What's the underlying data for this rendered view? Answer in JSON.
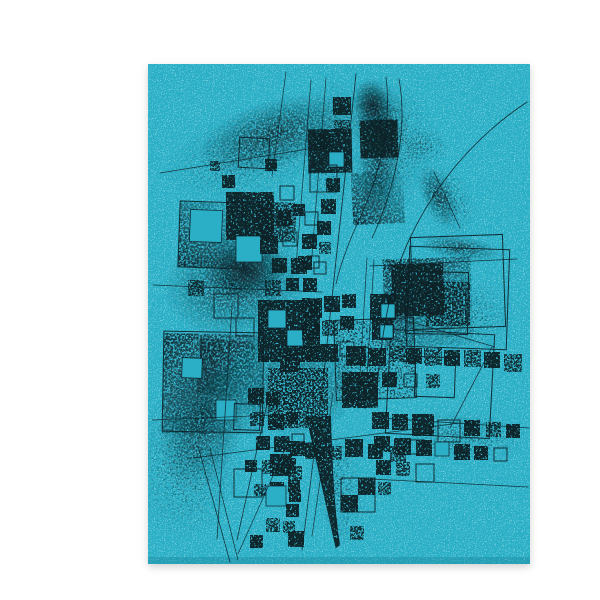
{
  "scene": {
    "description": "Abstract geometric ink print on bright teal paper: stippled squares, thin straight lines and sweeping arcs in black ink, photographed on a white background",
    "background_color": "#ffffff",
    "canvas": {
      "width": 600,
      "height": 600
    },
    "paper": {
      "x": 108,
      "y": 48,
      "width": 382,
      "height": 500,
      "color": "#2bafc7"
    }
  },
  "palette": {
    "ink": "#0c2027",
    "ink_soft": "#123039",
    "paper_teal": "#2bafc7",
    "paper_speckle": "#bdeef2",
    "edge_shade": "#147f96",
    "shadow": "#000000"
  },
  "artwork": {
    "squares": [
      [
        139,
        186,
        66,
        "gbl",
        2
      ],
      [
        123,
        318,
        100,
        "gtl",
        1
      ],
      [
        344,
        242,
        88,
        "gtl",
        -2
      ],
      [
        352,
        248,
        52,
        "d",
        -2
      ],
      [
        295,
        303,
        80,
        "l",
        -2
      ],
      [
        186,
        176,
        48,
        "d",
        0
      ],
      [
        216,
        186,
        40,
        "m",
        2
      ],
      [
        268,
        113,
        44,
        "d",
        -1
      ],
      [
        320,
        104,
        38,
        "d",
        -2
      ],
      [
        312,
        156,
        52,
        "gbl",
        -3
      ],
      [
        218,
        284,
        62,
        "d",
        0
      ],
      [
        158,
        324,
        56,
        "gtl",
        3
      ],
      [
        228,
        352,
        60,
        "m",
        0
      ],
      [
        386,
        266,
        44,
        "m",
        0
      ],
      [
        302,
        356,
        36,
        "d",
        0
      ],
      [
        139,
        186,
        66,
        "o",
        2
      ],
      [
        123,
        316,
        100,
        "o",
        1
      ],
      [
        368,
        232,
        100,
        "o",
        2
      ],
      [
        372,
        220,
        92,
        "o",
        -2
      ],
      [
        366,
        256,
        62,
        "o",
        1
      ],
      [
        348,
        316,
        104,
        "o",
        3
      ],
      [
        295,
        303,
        80,
        "o",
        -2
      ],
      [
        375,
        341,
        40,
        "o",
        2
      ],
      [
        199,
        122,
        30,
        "o",
        3
      ],
      [
        225,
        143,
        12,
        "d",
        0
      ],
      [
        182,
        159,
        13,
        "d",
        0
      ],
      [
        170,
        145,
        10,
        "m",
        0
      ],
      [
        293,
        81,
        18,
        "d",
        0
      ],
      [
        294,
        104,
        16,
        "m",
        0
      ],
      [
        273,
        117,
        17,
        "d",
        0
      ],
      [
        289,
        136,
        15,
        "h",
        0
      ],
      [
        270,
        149,
        27,
        "o",
        0
      ],
      [
        286,
        162,
        14,
        "d",
        0
      ],
      [
        281,
        183,
        15,
        "d",
        0
      ],
      [
        265,
        196,
        13,
        "o",
        0
      ],
      [
        277,
        205,
        14,
        "d",
        0
      ],
      [
        262,
        218,
        15,
        "d",
        0
      ],
      [
        279,
        226,
        12,
        "m",
        0
      ],
      [
        258,
        240,
        14,
        "d",
        0
      ],
      [
        274,
        246,
        12,
        "o",
        0
      ],
      [
        150,
        194,
        32,
        "h",
        2
      ],
      [
        196,
        220,
        26,
        "h",
        0
      ],
      [
        240,
        170,
        14,
        "o",
        0
      ],
      [
        236,
        194,
        16,
        "d",
        0
      ],
      [
        253,
        188,
        12,
        "d",
        0
      ],
      [
        220,
        220,
        18,
        "d",
        0
      ],
      [
        243,
        216,
        14,
        "o",
        0
      ],
      [
        232,
        242,
        15,
        "d",
        0
      ],
      [
        251,
        242,
        16,
        "d",
        0
      ],
      [
        267,
        240,
        12,
        "o",
        0
      ],
      [
        174,
        278,
        24,
        "o",
        0
      ],
      [
        148,
        264,
        16,
        "m",
        0
      ],
      [
        225,
        264,
        16,
        "m",
        0
      ],
      [
        246,
        262,
        13,
        "d",
        0
      ],
      [
        263,
        262,
        14,
        "d",
        0
      ],
      [
        262,
        282,
        20,
        "d",
        0
      ],
      [
        284,
        280,
        16,
        "d",
        0
      ],
      [
        302,
        278,
        14,
        "d",
        0
      ],
      [
        228,
        294,
        18,
        "h",
        0
      ],
      [
        247,
        314,
        16,
        "h",
        0
      ],
      [
        262,
        306,
        18,
        "d",
        0
      ],
      [
        282,
        304,
        16,
        "m",
        0
      ],
      [
        300,
        300,
        14,
        "d",
        0
      ],
      [
        330,
        278,
        26,
        "d",
        0
      ],
      [
        332,
        302,
        22,
        "d",
        0
      ],
      [
        341,
        288,
        14,
        "h",
        0
      ],
      [
        340,
        309,
        13,
        "h",
        0
      ],
      [
        240,
        336,
        20,
        "d",
        0
      ],
      [
        262,
        330,
        16,
        "d",
        0
      ],
      [
        280,
        328,
        18,
        "d",
        0
      ],
      [
        300,
        326,
        14,
        "o",
        0
      ],
      [
        176,
        384,
        20,
        "h",
        0
      ],
      [
        196,
        302,
        18,
        "o",
        0
      ],
      [
        142,
        342,
        20,
        "h",
        2
      ],
      [
        194,
        388,
        26,
        "o",
        2
      ],
      [
        208,
        372,
        16,
        "d",
        0
      ],
      [
        226,
        376,
        14,
        "d",
        0
      ],
      [
        244,
        374,
        16,
        "m",
        0
      ],
      [
        210,
        396,
        14,
        "m",
        0
      ],
      [
        228,
        398,
        16,
        "d",
        0
      ],
      [
        246,
        396,
        12,
        "d",
        0
      ],
      [
        216,
        420,
        14,
        "d",
        0
      ],
      [
        234,
        420,
        16,
        "d",
        0
      ],
      [
        252,
        418,
        12,
        "o",
        0
      ],
      [
        205,
        444,
        12,
        "d",
        0
      ],
      [
        222,
        444,
        14,
        "m",
        0
      ],
      [
        240,
        442,
        16,
        "d",
        0
      ],
      [
        214,
        468,
        12,
        "m",
        0
      ],
      [
        230,
        466,
        14,
        "d",
        0
      ],
      [
        248,
        464,
        12,
        "d",
        0
      ],
      [
        250,
        425,
        15,
        "d",
        0
      ],
      [
        248,
        450,
        14,
        "m",
        0
      ],
      [
        249,
        474,
        12,
        "d",
        0
      ],
      [
        246,
        488,
        13,
        "d",
        0
      ],
      [
        243,
        505,
        12,
        "m",
        0
      ],
      [
        248,
        515,
        16,
        "d",
        0
      ],
      [
        210,
        519,
        13,
        "d",
        0
      ],
      [
        226,
        502,
        14,
        "m",
        0
      ],
      [
        226,
        470,
        20,
        "h",
        0
      ],
      [
        194,
        453,
        28,
        "o",
        0
      ],
      [
        230,
        438,
        22,
        "d",
        0
      ],
      [
        265,
        427,
        16,
        "d",
        0
      ],
      [
        288,
        430,
        14,
        "m",
        0
      ],
      [
        305,
        423,
        18,
        "d",
        0
      ],
      [
        328,
        428,
        15,
        "d",
        0
      ],
      [
        350,
        430,
        16,
        "m",
        0
      ],
      [
        370,
        424,
        14,
        "o",
        0
      ],
      [
        301,
        462,
        34,
        "o",
        0
      ],
      [
        318,
        462,
        17,
        "d",
        0
      ],
      [
        301,
        479,
        17,
        "d",
        0
      ],
      [
        310,
        510,
        14,
        "m",
        0
      ],
      [
        306,
        330,
        20,
        "d",
        0
      ],
      [
        328,
        332,
        18,
        "d",
        0
      ],
      [
        350,
        330,
        16,
        "m",
        0
      ],
      [
        366,
        332,
        16,
        "d",
        0
      ],
      [
        384,
        332,
        18,
        "m",
        0
      ],
      [
        404,
        334,
        16,
        "d",
        0
      ],
      [
        424,
        334,
        17,
        "m",
        0
      ],
      [
        444,
        336,
        16,
        "d",
        0
      ],
      [
        464,
        338,
        18,
        "m",
        0
      ],
      [
        320,
        356,
        14,
        "m",
        0
      ],
      [
        342,
        356,
        15,
        "d",
        0
      ],
      [
        364,
        358,
        13,
        "o",
        0
      ],
      [
        386,
        358,
        14,
        "m",
        0
      ],
      [
        332,
        396,
        17,
        "d",
        0
      ],
      [
        352,
        398,
        16,
        "d",
        0
      ],
      [
        372,
        398,
        22,
        "d",
        0
      ],
      [
        398,
        404,
        22,
        "o",
        0
      ],
      [
        424,
        404,
        16,
        "d",
        0
      ],
      [
        446,
        406,
        15,
        "m",
        0
      ],
      [
        466,
        408,
        14,
        "d",
        0
      ],
      [
        334,
        420,
        16,
        "d",
        0
      ],
      [
        354,
        422,
        17,
        "d",
        0
      ],
      [
        376,
        424,
        16,
        "d",
        0
      ],
      [
        395,
        426,
        14,
        "h",
        0
      ],
      [
        414,
        428,
        16,
        "d",
        0
      ],
      [
        434,
        430,
        14,
        "d",
        0
      ],
      [
        454,
        432,
        13,
        "o",
        0
      ],
      [
        336,
        444,
        15,
        "d",
        0
      ],
      [
        356,
        446,
        14,
        "m",
        0
      ],
      [
        376,
        448,
        18,
        "o",
        0
      ],
      [
        338,
        466,
        13,
        "m",
        0
      ]
    ],
    "lines": [
      [
        120,
        157,
        305,
        127,
        0.8
      ],
      [
        113,
        269,
        282,
        276,
        0.8
      ],
      [
        330,
        250,
        477,
        243,
        0.8
      ],
      [
        153,
        442,
        420,
        407,
        0.8
      ],
      [
        340,
        402,
        489,
        412,
        0.8
      ],
      [
        331,
        463,
        488,
        471,
        0.8
      ],
      [
        112,
        404,
        235,
        399,
        0.7
      ],
      [
        192,
        290,
        177,
        523,
        0.8
      ],
      [
        227,
        388,
        197,
        524,
        0.8
      ],
      [
        245,
        433,
        198,
        538,
        0.7
      ],
      [
        316,
        58,
        282,
        375,
        0.9
      ],
      [
        246,
        56,
        232,
        160,
        0.7
      ],
      [
        271,
        64,
        256,
        250,
        0.7
      ],
      [
        286,
        62,
        271,
        252,
        0.7
      ],
      [
        282,
        375,
        262,
        534,
        0.8
      ],
      [
        293,
        377,
        272,
        520,
        0.7
      ],
      [
        327,
        242,
        318,
        392,
        0.7
      ],
      [
        334,
        244,
        325,
        393,
        0.7
      ],
      [
        452,
        331,
        410,
        412,
        0.8
      ],
      [
        358,
        302,
        455,
        331,
        0.8
      ],
      [
        394,
        156,
        420,
        212,
        0.7
      ],
      [
        158,
        430,
        190,
        546,
        0.8
      ],
      [
        170,
        432,
        198,
        544,
        0.7
      ]
    ],
    "curves": [
      [
        "M487,86 C436,120 397,165 370,222 C352,258 340,320 336,388",
        0.9
      ],
      [
        "M346,61 C352,108 340,160 318,206 C308,228 300,250 296,268",
        0.8
      ],
      [
        "M359,63 C368,112 356,170 332,222",
        0.8
      ],
      [
        "M266,398 C278,452 288,498 296,532",
        0.7
      ],
      [
        "M290,398 C292,446 294,492 299,530",
        0.7
      ]
    ],
    "blades": [
      "M266,400 C278,452 288,496 296,532 L300,529 C294,490 292,444 291,400 Z"
    ],
    "clouds": [
      [
        235,
        118,
        80,
        34,
        -18,
        "m"
      ],
      [
        215,
        135,
        95,
        45,
        -18,
        "s"
      ],
      [
        338,
        105,
        30,
        45,
        -15,
        "m"
      ],
      [
        333,
        90,
        18,
        26,
        -15,
        "d"
      ],
      [
        338,
        152,
        22,
        55,
        6,
        "m"
      ],
      [
        352,
        135,
        40,
        70,
        10,
        "s"
      ],
      [
        385,
        130,
        26,
        20,
        0,
        "s"
      ],
      [
        398,
        180,
        16,
        34,
        -25,
        "m"
      ],
      [
        420,
        232,
        40,
        12,
        8,
        "m"
      ],
      [
        195,
        268,
        72,
        55,
        -8,
        "m"
      ],
      [
        207,
        254,
        40,
        30,
        -8,
        "d"
      ],
      [
        163,
        400,
        42,
        75,
        14,
        "m"
      ],
      [
        150,
        442,
        55,
        85,
        10,
        "s"
      ],
      [
        255,
        372,
        62,
        48,
        0,
        "m"
      ],
      [
        420,
        420,
        70,
        26,
        3,
        "s"
      ],
      [
        292,
        130,
        28,
        70,
        4,
        "s"
      ],
      [
        298,
        470,
        26,
        65,
        -10,
        "s"
      ],
      [
        418,
        300,
        55,
        40,
        0,
        "s"
      ],
      [
        408,
        185,
        26,
        38,
        -25,
        "s"
      ]
    ]
  }
}
